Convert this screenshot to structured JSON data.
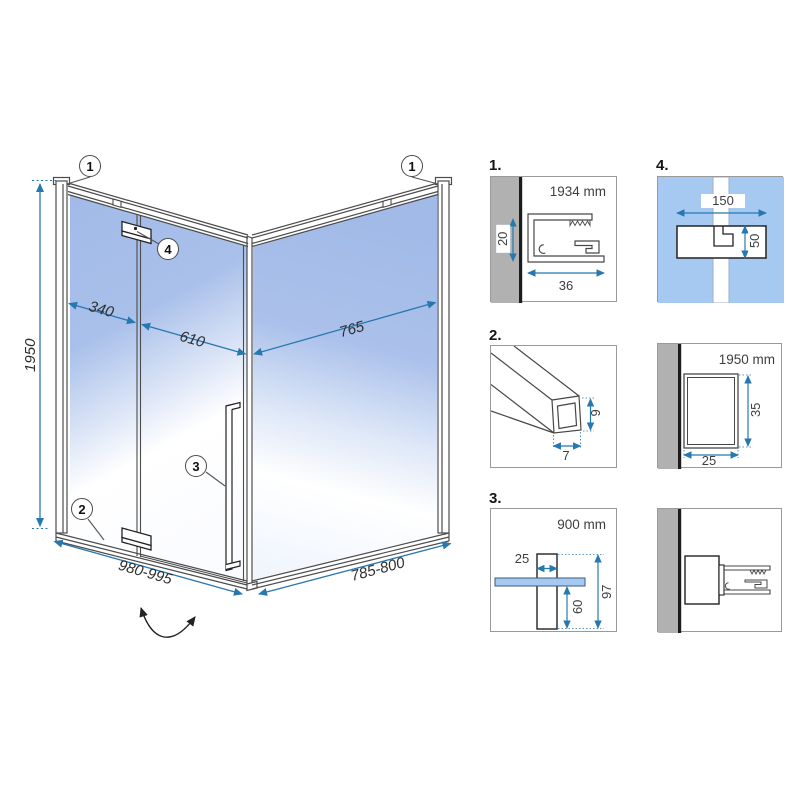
{
  "main": {
    "dims": {
      "height": "1950",
      "fixed_panel": "340",
      "door": "610",
      "side_panel": "765",
      "front_width": "980-995",
      "side_width": "785-800"
    },
    "callouts": {
      "c1_left": "1",
      "c1_right": "1",
      "c2": "2",
      "c3": "3",
      "c4": "4"
    }
  },
  "details": {
    "d1": {
      "label": "1.",
      "length": "1934 mm",
      "height": "20",
      "width": "36"
    },
    "d2": {
      "label": "2.",
      "height": "9",
      "width": "7"
    },
    "d3": {
      "label": "3.",
      "length": "900 mm",
      "width": "25",
      "below_glass": "60",
      "total_height": "97"
    },
    "d4": {
      "label": "4.",
      "width": "150",
      "height": "50"
    },
    "d5": {
      "length": "1950 mm",
      "height": "35",
      "width": "25"
    }
  },
  "colors": {
    "dimension_blue": "#2878b0",
    "glass_blue": "#a5bce9",
    "detail_glass_blue": "#a6c9f1",
    "wall_gray": "#b1b1b1"
  }
}
